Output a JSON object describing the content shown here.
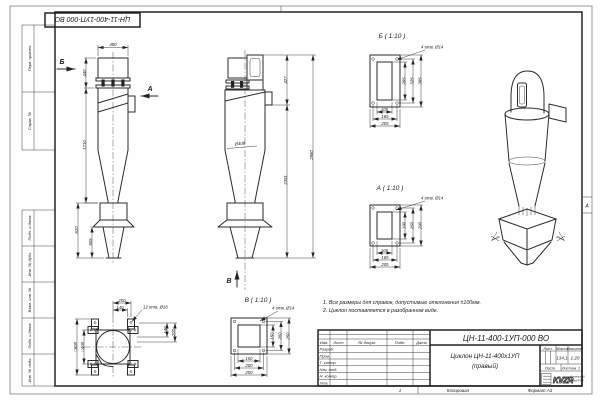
{
  "sheet": {
    "stamp_top": "ЦН-11-400-1УП-000 ВО",
    "zone_marker": "А",
    "footer_num": "1",
    "kopiroval": "Копировал",
    "format_note": "Формат А3"
  },
  "margins": {
    "perv_primen": "Перв. примен.",
    "sprav_no": "Справ. №",
    "podp_data_1": "Подп. и дата",
    "inv_dubl": "Инв. № дубл.",
    "vzam_inv": "Взам. инв. №",
    "podp_data_2": "Подп. и дата",
    "inv_podl": "Инв. № подл."
  },
  "views": {
    "front": {
      "arrow_b": "Б",
      "arrow_a": "А",
      "dim_width": "480",
      "dim_top": "440",
      "dim_body": "1710",
      "dim_bin": "810",
      "dim_bin_inner": "505"
    },
    "side": {
      "arrow_v": "В",
      "dia_body": "Ø408",
      "dim_top": "427",
      "dim_lower": "2351",
      "dim_total": "2960"
    },
    "plan": {
      "dim_200": "200",
      "dim_140": "140",
      "holes": "12 отв. Ø18",
      "dim_r140": "140",
      "dim_r200": "200",
      "sq_outer": "□608",
      "sq_inner": "□408"
    },
    "detail_b": {
      "title": "Б ( 1:10 )",
      "holes": "4 отв. Ø14",
      "h_inner": "265",
      "h_holes": "325",
      "h_outer": "365",
      "w_inner": "105",
      "w_holes": "165",
      "w_outer": "205"
    },
    "detail_a": {
      "title": "А ( 1:10 )",
      "holes": "4 отв. Ø14",
      "h_inner": "190",
      "h_holes": "250",
      "h_outer": "290",
      "w_inner": "105",
      "w_holes": "165",
      "w_outer": "205"
    },
    "detail_v": {
      "title": "В ( 1:10 )",
      "holes": "4 отв. Ø14",
      "h_inner": "150",
      "h_holes": "200",
      "h_outer": "250",
      "w_inner": "150",
      "w_holes": "200",
      "w_outer": "250"
    }
  },
  "notes": {
    "line1": "1. Все размеры для справок, допустимые отклонения ±100мм.",
    "line2": "2. Циклон поставляется в разобранном виде."
  },
  "title_block": {
    "designation": "ЦН-11-400-1УП-000 ВО",
    "name_line1": "Циклон ЦН-11-400х1УП",
    "name_line2": "(правый)",
    "col_izm": "Изм.",
    "col_list": "Лист",
    "col_doc": "№ докум.",
    "col_podp": "Подп.",
    "col_data": "Дата",
    "rows": [
      "Разраб.",
      "Пров.",
      "Т. контр.",
      "Нач. отд.",
      "Н. контр.",
      "Утв."
    ],
    "lit_label": "Лит.",
    "mass_label": "Масса",
    "scale_label": "Масштаб",
    "mass": "134,1",
    "scale": "1:20",
    "sheet_label": "Лист",
    "sheets_label": "Листов",
    "sheets_value": "1",
    "logo": "KVZR",
    "company_line1": "Котельный",
    "company_line2": "завод РЭП"
  }
}
